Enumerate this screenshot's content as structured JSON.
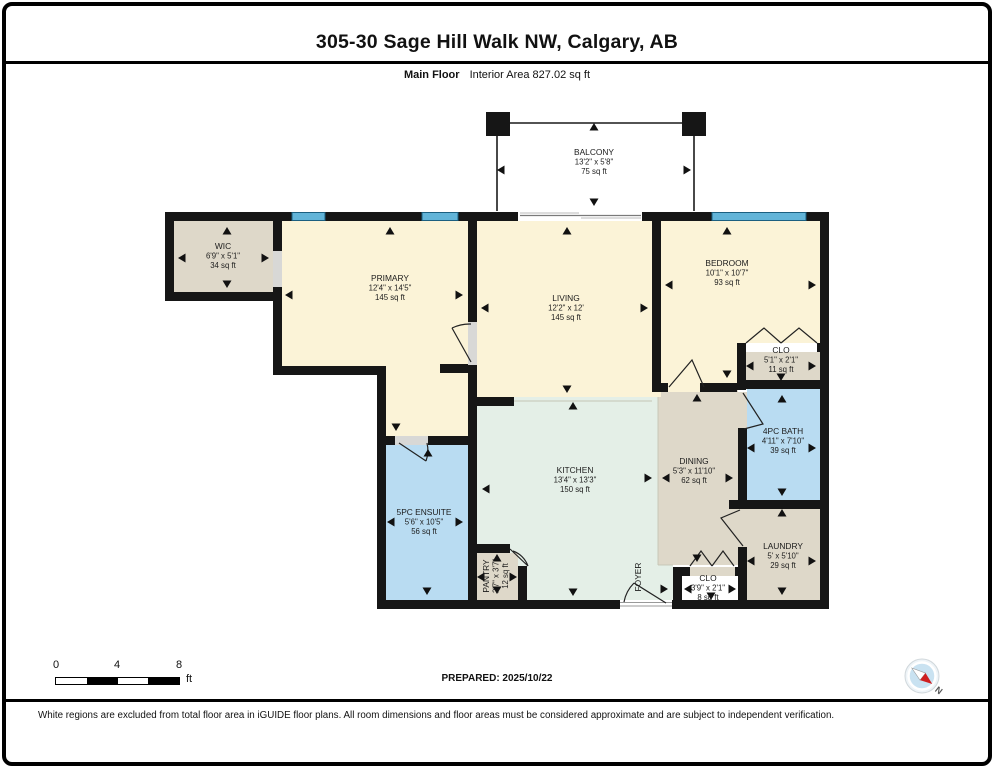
{
  "header": {
    "title": "305-30 Sage Hill Walk NW, Calgary, AB",
    "floor_label": "Main Floor",
    "area_label": "Interior Area 827.02 sq ft"
  },
  "footer": {
    "prepared": "PREPARED: 2025/10/22",
    "disclaimer": "White regions are excluded from total floor area in iGUIDE floor plans. All room dimensions and floor areas must be considered approximate and are subject to independent verification.",
    "scale": {
      "ticks": [
        "0",
        "4",
        "8"
      ],
      "unit": "ft"
    },
    "compass_n": "N"
  },
  "colors": {
    "cream": "#fbf3d7",
    "tan": "#ded8c9",
    "blue": "#b9dcf2",
    "mint": "#e4efe7",
    "wall": "#161616",
    "window": "#62b4d8",
    "windowEdge": "#1b5f80",
    "sill": "#d8d8d6",
    "compass": "#c9e2f1",
    "needle_red": "#cf1f1f"
  },
  "plan": {
    "fills": [
      {
        "x": 174,
        "y": 221,
        "w": 99,
        "h": 71,
        "c": "tan"
      },
      {
        "x": 282,
        "y": 221,
        "w": 188,
        "h": 145,
        "c": "cream"
      },
      {
        "x": 386,
        "y": 366,
        "w": 82,
        "h": 79,
        "c": "cream"
      },
      {
        "x": 477,
        "y": 221,
        "w": 175,
        "h": 176,
        "c": "cream"
      },
      {
        "x": 661,
        "y": 221,
        "w": 76,
        "h": 162,
        "c": "cream"
      },
      {
        "x": 737,
        "y": 221,
        "w": 83,
        "h": 122,
        "c": "cream"
      },
      {
        "x": 746,
        "y": 352,
        "w": 74,
        "h": 28,
        "c": "tan"
      },
      {
        "x": 747,
        "y": 389,
        "w": 73,
        "h": 111,
        "c": "blue"
      },
      {
        "x": 747,
        "y": 509,
        "w": 73,
        "h": 91,
        "c": "tan"
      },
      {
        "x": 658,
        "y": 390,
        "w": 80,
        "h": 175,
        "c": "tan"
      },
      {
        "x": 477,
        "y": 397,
        "w": 181,
        "h": 203,
        "c": "mint"
      },
      {
        "x": 658,
        "y": 565,
        "w": 15,
        "h": 35,
        "c": "mint"
      },
      {
        "x": 386,
        "y": 445,
        "w": 82,
        "h": 155,
        "c": "blue"
      },
      {
        "x": 477,
        "y": 553,
        "w": 41,
        "h": 47,
        "c": "tan"
      },
      {
        "x": 652,
        "y": 383,
        "w": 9,
        "h": 14,
        "c": "cream"
      },
      {
        "x": 738,
        "y": 392,
        "w": 9,
        "h": 36,
        "c": "tan"
      },
      {
        "x": 738,
        "y": 509,
        "w": 9,
        "h": 38,
        "c": "tan"
      },
      {
        "x": 668,
        "y": 383,
        "w": 32,
        "h": 9,
        "c": "cream"
      },
      {
        "x": 690,
        "y": 567,
        "w": 45,
        "h": 9,
        "c": "tan"
      },
      {
        "x": 510,
        "y": 544,
        "w": 17,
        "h": 9,
        "c": "mint"
      }
    ],
    "boundaries": [
      [
        514,
        401,
        652,
        401
      ],
      [
        658,
        397,
        658,
        565
      ],
      [
        658,
        565,
        673,
        565
      ]
    ],
    "walls": [
      {
        "x": 165,
        "y": 212,
        "w": 664,
        "h": 9
      },
      {
        "x": 165,
        "y": 212,
        "w": 9,
        "h": 89
      },
      {
        "x": 165,
        "y": 292,
        "w": 117,
        "h": 9
      },
      {
        "x": 273,
        "y": 221,
        "w": 9,
        "h": 30
      },
      {
        "x": 273,
        "y": 287,
        "w": 9,
        "h": 14
      },
      {
        "x": 273,
        "y": 301,
        "w": 9,
        "h": 74
      },
      {
        "x": 273,
        "y": 366,
        "w": 113,
        "h": 9
      },
      {
        "x": 377,
        "y": 366,
        "w": 9,
        "h": 79
      },
      {
        "x": 377,
        "y": 436,
        "w": 18,
        "h": 9
      },
      {
        "x": 428,
        "y": 436,
        "w": 49,
        "h": 9
      },
      {
        "x": 377,
        "y": 436,
        "w": 9,
        "h": 173
      },
      {
        "x": 377,
        "y": 600,
        "w": 243,
        "h": 9
      },
      {
        "x": 672,
        "y": 600,
        "w": 157,
        "h": 9
      },
      {
        "x": 820,
        "y": 212,
        "w": 9,
        "h": 397
      },
      {
        "x": 468,
        "y": 221,
        "w": 9,
        "h": 101
      },
      {
        "x": 468,
        "y": 365,
        "w": 9,
        "h": 244
      },
      {
        "x": 440,
        "y": 364,
        "w": 37,
        "h": 9
      },
      {
        "x": 477,
        "y": 397,
        "w": 37,
        "h": 9
      },
      {
        "x": 652,
        "y": 221,
        "w": 9,
        "h": 162
      },
      {
        "x": 652,
        "y": 383,
        "w": 16,
        "h": 9
      },
      {
        "x": 700,
        "y": 383,
        "w": 37,
        "h": 9
      },
      {
        "x": 737,
        "y": 343,
        "w": 9,
        "h": 9
      },
      {
        "x": 817,
        "y": 343,
        "w": 12,
        "h": 9
      },
      {
        "x": 737,
        "y": 343,
        "w": 9,
        "h": 47
      },
      {
        "x": 737,
        "y": 380,
        "w": 92,
        "h": 9
      },
      {
        "x": 738,
        "y": 428,
        "w": 9,
        "h": 72
      },
      {
        "x": 729,
        "y": 500,
        "w": 100,
        "h": 9
      },
      {
        "x": 738,
        "y": 547,
        "w": 9,
        "h": 62
      },
      {
        "x": 673,
        "y": 567,
        "w": 9,
        "h": 42
      },
      {
        "x": 673,
        "y": 567,
        "w": 17,
        "h": 9
      },
      {
        "x": 735,
        "y": 567,
        "w": 12,
        "h": 9
      },
      {
        "x": 468,
        "y": 544,
        "w": 42,
        "h": 9
      },
      {
        "x": 518,
        "y": 566,
        "w": 9,
        "h": 43
      },
      {
        "x": 486,
        "y": 112,
        "w": 24,
        "h": 24
      },
      {
        "x": 682,
        "y": 112,
        "w": 24,
        "h": 24
      }
    ],
    "sills": [
      {
        "x": 273,
        "y": 251,
        "w": 9,
        "h": 36
      },
      {
        "x": 468,
        "y": 322,
        "w": 9,
        "h": 43
      },
      {
        "x": 395,
        "y": 436,
        "w": 33,
        "h": 9
      }
    ],
    "openings": [
      {
        "x": 518,
        "y": 212,
        "w": 124,
        "h": 9
      },
      {
        "x": 620,
        "y": 600,
        "w": 52,
        "h": 9
      }
    ],
    "windows": [
      {
        "x": 292,
        "w": 33
      },
      {
        "x": 422,
        "w": 36
      },
      {
        "x": 712,
        "w": 94
      }
    ],
    "lines": [
      {
        "p": [
          510,
          123,
          682,
          123
        ],
        "s": "#1a1a1a",
        "w": 1.6
      },
      {
        "p": [
          497,
          136,
          497,
          211
        ],
        "s": "#1a1a1a",
        "w": 1.6
      },
      {
        "p": [
          694,
          136,
          694,
          211
        ],
        "s": "#1a1a1a",
        "w": 1.6
      },
      {
        "p": [
          520,
          215.5,
          641,
          215.5
        ],
        "s": "#7a7a7a",
        "w": 1.2
      },
      {
        "p": [
          520,
          213,
          579,
          213
        ],
        "s": "#bbbbbb",
        "w": 1
      },
      {
        "p": [
          581,
          218,
          641,
          218
        ],
        "s": "#bbbbbb",
        "w": 1
      },
      {
        "p": [
          620,
          602.5,
          672,
          602.5
        ],
        "s": "#999999",
        "w": 1
      },
      {
        "p": [
          620,
          606,
          672,
          606
        ],
        "s": "#999999",
        "w": 1
      }
    ],
    "doors": [
      "M452,328 L471,362 M452,328 A41,41 0 0 1 471,324",
      "M399,443 L426,461 M426,461 A31,31 0 0 0 427,443",
      "M669,387 L692,360 L704,387",
      "M743,393 L763,424 L744,429",
      "M743,546 L721,518 L740,510",
      "M746,343 L764,328 L781,343 M781,343 L799,328 L817,343",
      "M690,566 L701,551 L712,566 M712,566 L723,551 L734,566",
      "M510,549 L528,566 M528,566 A25,25 0 0 0 513,551",
      "M666,603 L634,583 M634,583 A36,36 0 0 0 624,602"
    ],
    "arrows": [
      {
        "x": 594,
        "y": 127,
        "d": "up"
      },
      {
        "x": 594,
        "y": 202,
        "d": "down"
      },
      {
        "x": 501,
        "y": 170,
        "d": "left"
      },
      {
        "x": 687,
        "y": 170,
        "d": "right"
      },
      {
        "x": 227,
        "y": 231,
        "d": "up"
      },
      {
        "x": 227,
        "y": 284,
        "d": "down"
      },
      {
        "x": 182,
        "y": 258,
        "d": "left"
      },
      {
        "x": 265,
        "y": 258,
        "d": "right"
      },
      {
        "x": 390,
        "y": 231,
        "d": "up"
      },
      {
        "x": 289,
        "y": 295,
        "d": "left"
      },
      {
        "x": 459,
        "y": 295,
        "d": "right"
      },
      {
        "x": 396,
        "y": 427,
        "d": "down"
      },
      {
        "x": 567,
        "y": 231,
        "d": "up"
      },
      {
        "x": 485,
        "y": 308,
        "d": "left"
      },
      {
        "x": 644,
        "y": 308,
        "d": "right"
      },
      {
        "x": 567,
        "y": 389,
        "d": "down"
      },
      {
        "x": 573,
        "y": 406,
        "d": "up"
      },
      {
        "x": 573,
        "y": 592,
        "d": "down"
      },
      {
        "x": 486,
        "y": 489,
        "d": "left"
      },
      {
        "x": 648,
        "y": 478,
        "d": "right"
      },
      {
        "x": 428,
        "y": 453,
        "d": "up"
      },
      {
        "x": 391,
        "y": 522,
        "d": "left"
      },
      {
        "x": 459,
        "y": 522,
        "d": "right"
      },
      {
        "x": 427,
        "y": 591,
        "d": "down"
      },
      {
        "x": 497,
        "y": 558,
        "d": "up"
      },
      {
        "x": 497,
        "y": 590,
        "d": "down"
      },
      {
        "x": 481,
        "y": 577,
        "d": "left"
      },
      {
        "x": 513,
        "y": 577,
        "d": "right"
      },
      {
        "x": 727,
        "y": 231,
        "d": "up"
      },
      {
        "x": 669,
        "y": 285,
        "d": "left"
      },
      {
        "x": 812,
        "y": 285,
        "d": "right"
      },
      {
        "x": 727,
        "y": 374,
        "d": "down"
      },
      {
        "x": 750,
        "y": 366,
        "d": "left"
      },
      {
        "x": 812,
        "y": 366,
        "d": "right"
      },
      {
        "x": 781,
        "y": 377,
        "d": "down"
      },
      {
        "x": 782,
        "y": 399,
        "d": "up"
      },
      {
        "x": 751,
        "y": 448,
        "d": "left"
      },
      {
        "x": 812,
        "y": 448,
        "d": "right"
      },
      {
        "x": 782,
        "y": 492,
        "d": "down"
      },
      {
        "x": 697,
        "y": 398,
        "d": "up"
      },
      {
        "x": 697,
        "y": 558,
        "d": "down"
      },
      {
        "x": 666,
        "y": 478,
        "d": "left"
      },
      {
        "x": 729,
        "y": 478,
        "d": "right"
      },
      {
        "x": 782,
        "y": 513,
        "d": "up"
      },
      {
        "x": 751,
        "y": 561,
        "d": "left"
      },
      {
        "x": 812,
        "y": 561,
        "d": "right"
      },
      {
        "x": 782,
        "y": 591,
        "d": "down"
      },
      {
        "x": 688,
        "y": 589,
        "d": "left"
      },
      {
        "x": 732,
        "y": 589,
        "d": "right"
      },
      {
        "x": 711,
        "y": 596,
        "d": "down"
      },
      {
        "x": 664,
        "y": 589,
        "d": "right"
      }
    ],
    "labels": [
      {
        "x": 594,
        "y": 155,
        "lines": [
          "BALCONY",
          "13'2\" x 5'8\"",
          "75 sq ft"
        ]
      },
      {
        "x": 223,
        "y": 249,
        "lines": [
          "WIC",
          "6'9\" x 5'1\"",
          "34 sq ft"
        ]
      },
      {
        "x": 390,
        "y": 281,
        "lines": [
          "PRIMARY",
          "12'4\" x 14'5\"",
          "145 sq ft"
        ]
      },
      {
        "x": 566,
        "y": 301,
        "lines": [
          "LIVING",
          "12'2\" x 12'",
          "145 sq ft"
        ]
      },
      {
        "x": 727,
        "y": 266,
        "lines": [
          "BEDROOM",
          "10'1\" x 10'7\"",
          "93 sq ft"
        ]
      },
      {
        "x": 781,
        "y": 353,
        "lines": [
          "CLO",
          "5'1\" x 2'1\"",
          "11 sq ft"
        ]
      },
      {
        "x": 783,
        "y": 434,
        "lines": [
          "4PC BATH",
          "4'11\" x 7'10\"",
          "39 sq ft"
        ]
      },
      {
        "x": 694,
        "y": 464,
        "lines": [
          "DINING",
          "5'3\" x 11'10\"",
          "62 sq ft"
        ]
      },
      {
        "x": 575,
        "y": 473,
        "lines": [
          "KITCHEN",
          "13'4\" x 13'3\"",
          "150 sq ft"
        ]
      },
      {
        "x": 424,
        "y": 515,
        "lines": [
          "5PC ENSUITE",
          "5'6\" x 10'5\"",
          "56 sq ft"
        ]
      },
      {
        "x": 783,
        "y": 549,
        "lines": [
          "LAUNDRY",
          "5' x 5'10\"",
          "29 sq ft"
        ]
      },
      {
        "x": 708,
        "y": 581,
        "lines": [
          "CLO",
          "3'9\" x 2'1\"",
          "8 sq ft"
        ]
      },
      {
        "x": 489,
        "y": 576,
        "rot": -90,
        "lines": [
          "PANTRY",
          "2'7\" x 3'7\"",
          "12 sq ft"
        ]
      },
      {
        "x": 641,
        "y": 577,
        "rot": -90,
        "lines": [
          "FOYER"
        ]
      }
    ],
    "compass": {
      "cx": 27,
      "cy": 26,
      "rot": 38
    }
  }
}
